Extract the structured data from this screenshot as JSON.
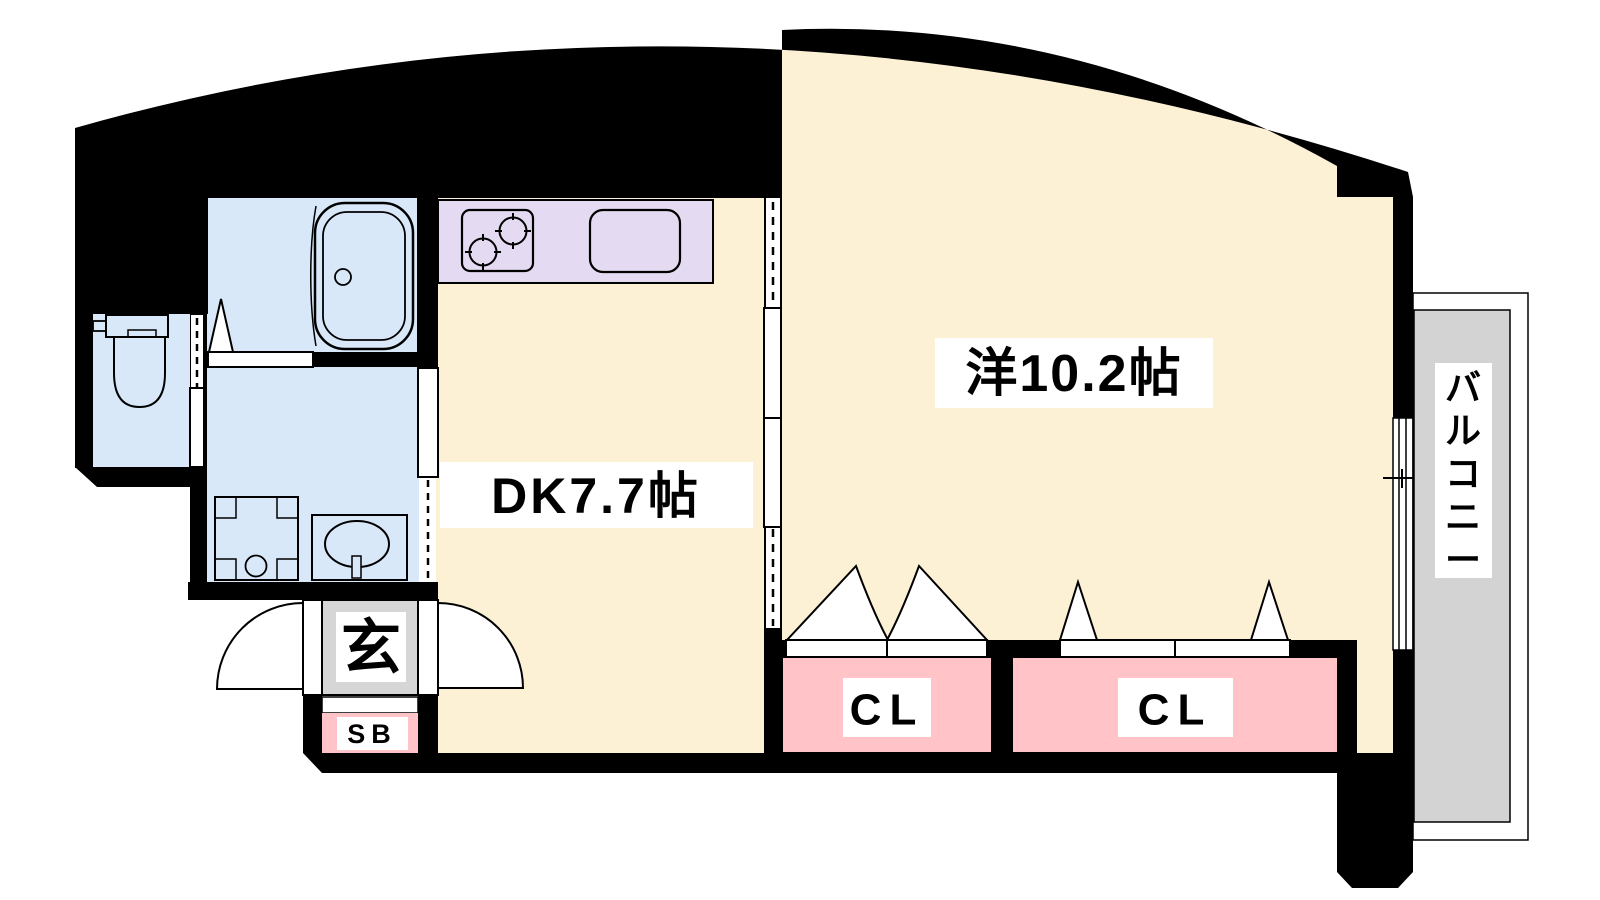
{
  "floor_plan": {
    "rooms": {
      "western_room": {
        "label": "洋10.2帖"
      },
      "dining_kitchen": {
        "label": "DK7.7帖"
      },
      "closet_left": {
        "label": "CL"
      },
      "closet_right": {
        "label": "CL"
      },
      "entrance": {
        "label": "玄"
      },
      "shoe_box": {
        "label": "SB"
      },
      "balcony": {
        "label": "バルコニー"
      }
    },
    "colors": {
      "room_cream": "#FCF0D5",
      "wet_area_blue": "#D9E8F9",
      "kitchen_lavender": "#E4DAF1",
      "closet_pink": "#FFC3C8",
      "balcony_gray": "#D3D3D3",
      "entrance_gray": "#D6D6D6",
      "wall_black": "#000000",
      "line_black": "#000000",
      "label_bg": "#FFFFFF"
    }
  }
}
